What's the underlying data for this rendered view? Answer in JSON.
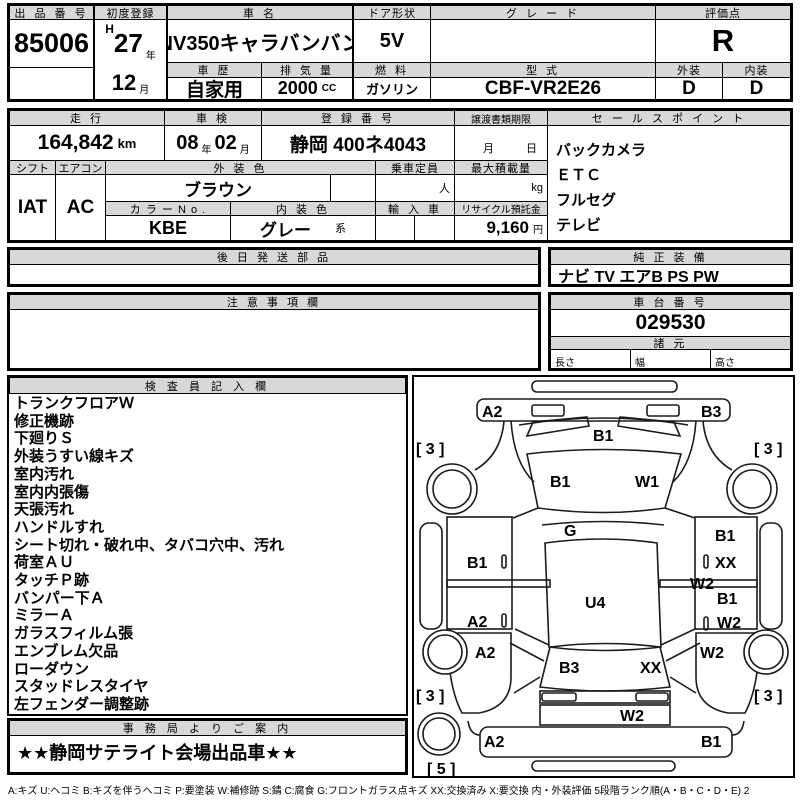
{
  "sheet": {
    "auction_no": {
      "label": "出 品 番 号",
      "value": "85006"
    },
    "first_reg": {
      "label": "初度登録",
      "era": "H",
      "year": "27",
      "year_u": "年",
      "month": "12",
      "month_u": "月"
    },
    "car_name": {
      "label": "車  名",
      "value": "NV350キャラバンバン"
    },
    "door": {
      "label": "ドア形状",
      "value": "5V"
    },
    "grade": {
      "label": "グ レ ー ド",
      "value": ""
    },
    "score": {
      "label": "評価点",
      "value": "R"
    },
    "history": {
      "label": "車 歴",
      "value": "自家用"
    },
    "displacement": {
      "label": "排 気 量",
      "value": "2000",
      "unit": "CC"
    },
    "fuel": {
      "label": "燃 料",
      "value": "ガソリン"
    },
    "model_code": {
      "label": "型 式",
      "value": "CBF-VR2E26"
    },
    "ext_grade": {
      "label": "外装",
      "value": "D"
    },
    "int_grade": {
      "label": "内装",
      "value": "D"
    },
    "mileage": {
      "label": "走 行",
      "value": "164,842",
      "unit": "km"
    },
    "shaken": {
      "label": "車 検",
      "year": "08",
      "year_u": "年",
      "month": "02",
      "month_u": "月"
    },
    "reg_no": {
      "label": "登 録 番 号",
      "value": "静岡 400ネ4043"
    },
    "transfer": {
      "label": "譲渡書類期限",
      "month_u": "月",
      "day_u": "日"
    },
    "shift": {
      "label": "シフト",
      "value": "IAT"
    },
    "aircon": {
      "label": "エアコン",
      "value": "AC"
    },
    "ext_color": {
      "label": "外 装 色",
      "value": "ブラウン"
    },
    "color_no": {
      "label": "カ ラ ー N o .",
      "value": "KBE"
    },
    "int_color": {
      "label": "内 装 色",
      "value": "グレー",
      "suffix": "系"
    },
    "capacity": {
      "label": "乗車定員",
      "unit": "人",
      "value": ""
    },
    "import_car": {
      "label": "輸 入 車",
      "value": ""
    },
    "max_load": {
      "label": "最大積載量",
      "unit": "kg",
      "value": ""
    },
    "recycle": {
      "label": "リサイクル預託金",
      "value": "9,160",
      "unit": "円"
    },
    "sales_points": {
      "label": "セ ー ル ス ポ イ ン ト",
      "items": [
        "バックカメラ",
        "ＥＴＣ",
        "フルセグ",
        "テレビ"
      ]
    },
    "later_parts": {
      "label": "後 日 発 送 部 品",
      "value": ""
    },
    "oem_equipment": {
      "label": "純 正 装 備",
      "value": "ナビ TV エアB PS PW"
    },
    "notes": {
      "label": "注 意 事 項 欄",
      "value": ""
    },
    "chassis": {
      "label": "車 台 番 号",
      "value": "029530"
    },
    "specs": {
      "label": "諸 元",
      "len": "長さ",
      "wid": "幅",
      "hei": "高さ",
      "len_v": "",
      "wid_v": "",
      "hei_v": ""
    },
    "inspector": {
      "label": "検 査 員 記 入 欄",
      "items": [
        "トランクフロアＷ",
        "修正機跡",
        "下廻りＳ",
        "外装うすい線キズ",
        "室内汚れ",
        "室内内張傷",
        "天張汚れ",
        "ハンドルすれ",
        "シート切れ・破れ中、タバコ穴中、汚れ",
        "荷室ＡＵ",
        "タッチＰ跡",
        "バンパー下Ａ",
        "ミラーＡ",
        "ガラスフィルム張",
        "エンブレム欠品",
        "ローダウン",
        "スタッドレスタイヤ",
        "左フェンダー調整跡"
      ]
    },
    "office": {
      "label": "事 務 局 よ り ご 案 内",
      "value": "★★静岡サテライト会場出品車★★"
    },
    "footer_legend": "A:キズ  U:ヘコミ  B:キズを伴うヘコミ  P:要塗装  W:補修跡  S:錆  C:腐食  G:フロントガラス点キズ  XX:交換済み  X:要交換   内・外装評価   5段階ランク順(A・B・C・D・E)  2"
  },
  "diagram": {
    "markers": [
      {
        "label": "A2"
      },
      {
        "label": "B3"
      },
      {
        "label": "B1"
      },
      {
        "label": "[ 3 ]"
      },
      {
        "label": "[ 3 ]"
      },
      {
        "label": "B1"
      },
      {
        "label": "W1"
      },
      {
        "label": "G"
      },
      {
        "label": "B1"
      },
      {
        "label": "B1"
      },
      {
        "label": "XX"
      },
      {
        "label": "W2"
      },
      {
        "label": "U4"
      },
      {
        "label": "B1"
      },
      {
        "label": "A2"
      },
      {
        "label": "W2"
      },
      {
        "label": "A2"
      },
      {
        "label": "W2"
      },
      {
        "label": "B3"
      },
      {
        "label": "XX"
      },
      {
        "label": "[ 3 ]"
      },
      {
        "label": "[ 3 ]"
      },
      {
        "label": "W2"
      },
      {
        "label": "A2"
      },
      {
        "label": "B1"
      },
      {
        "label": "[ 5 ]"
      }
    ]
  }
}
